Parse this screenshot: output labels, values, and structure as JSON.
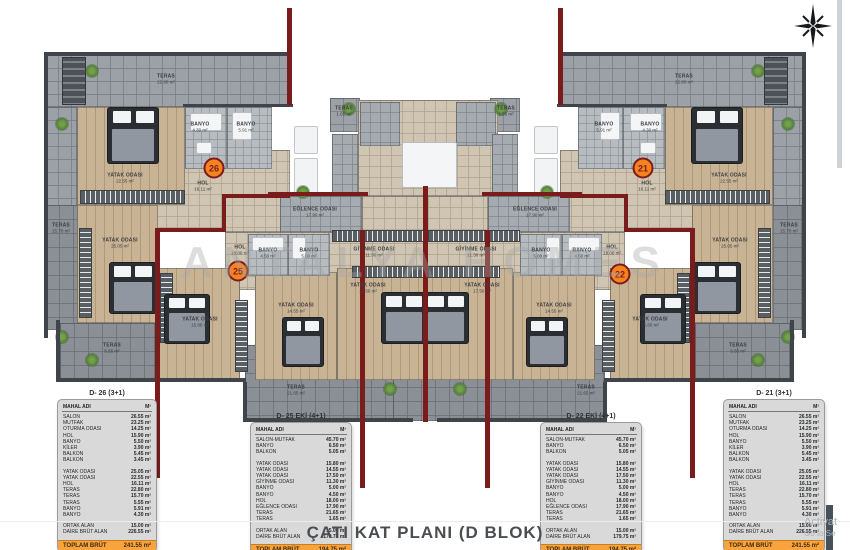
{
  "page": {
    "title": "ÇATI KAT PLANI (D BLOK)",
    "watermark": "ANTALYA HOMES"
  },
  "system": {
    "activate_line1": "Activat",
    "activate_line2": "Go to Se"
  },
  "colors": {
    "accent_orange": "#F5821F",
    "wall_red": "#7B1C1C",
    "total_band": "#F9A33C"
  },
  "badges": [
    {
      "number": "26",
      "x": 214,
      "y": 168
    },
    {
      "number": "25",
      "x": 238,
      "y": 271
    },
    {
      "number": "22",
      "x": 620,
      "y": 274
    },
    {
      "number": "21",
      "x": 643,
      "y": 168
    }
  ],
  "rooms": [
    {
      "name": "TERAS",
      "area": "22.80 m²",
      "x": 166,
      "y": 79
    },
    {
      "name": "TERAS",
      "area": "22.80 m²",
      "x": 684,
      "y": 79
    },
    {
      "name": "TERAS",
      "area": "15.70 m²",
      "x": 61,
      "y": 228
    },
    {
      "name": "TERAS",
      "area": "15.70 m²",
      "x": 789,
      "y": 228
    },
    {
      "name": "TERAS",
      "area": "5.55 m²",
      "x": 112,
      "y": 348
    },
    {
      "name": "TERAS",
      "area": "5.55 m²",
      "x": 738,
      "y": 348
    },
    {
      "name": "TERAS",
      "area": "21.65 m²",
      "x": 296,
      "y": 390
    },
    {
      "name": "TERAS",
      "area": "21.65 m²",
      "x": 586,
      "y": 390
    },
    {
      "name": "TERAS",
      "area": "1.65 m²",
      "x": 344,
      "y": 111
    },
    {
      "name": "TERAS",
      "area": "1.65 m²",
      "x": 506,
      "y": 111
    },
    {
      "name": "YATAK ODASI",
      "area": "22.55 m²",
      "x": 125,
      "y": 178
    },
    {
      "name": "YATAK ODASI",
      "area": "22.55 m²",
      "x": 729,
      "y": 178
    },
    {
      "name": "YATAK ODASI",
      "area": "25.05 m²",
      "x": 120,
      "y": 243
    },
    {
      "name": "YATAK ODASI",
      "area": "25.05 m²",
      "x": 730,
      "y": 243
    },
    {
      "name": "YATAK ODASI",
      "area": "15.80 m²",
      "x": 200,
      "y": 322
    },
    {
      "name": "YATAK ODASI",
      "area": "15.80 m²",
      "x": 650,
      "y": 322
    },
    {
      "name": "YATAK ODASI",
      "area": "14.55 m²",
      "x": 296,
      "y": 308
    },
    {
      "name": "YATAK ODASI",
      "area": "14.55 m²",
      "x": 554,
      "y": 308
    },
    {
      "name": "YATAK ODASI",
      "area": "17.50 m²",
      "x": 368,
      "y": 288
    },
    {
      "name": "YATAK ODASI",
      "area": "17.50 m²",
      "x": 482,
      "y": 288
    },
    {
      "name": "BANYO",
      "area": "4.30 m²",
      "x": 200,
      "y": 127
    },
    {
      "name": "BANYO",
      "area": "5.91 m²",
      "x": 246,
      "y": 127
    },
    {
      "name": "BANYO",
      "area": "5.91 m²",
      "x": 604,
      "y": 127
    },
    {
      "name": "BANYO",
      "area": "4.30 m²",
      "x": 650,
      "y": 127
    },
    {
      "name": "HOL",
      "area": "16.11 m²",
      "x": 203,
      "y": 186
    },
    {
      "name": "HOL",
      "area": "16.11 m²",
      "x": 647,
      "y": 186
    },
    {
      "name": "EĞLENCE ODASI",
      "area": "17.90 m²",
      "x": 315,
      "y": 212
    },
    {
      "name": "EĞLENCE ODASI",
      "area": "17.90 m²",
      "x": 535,
      "y": 212
    },
    {
      "name": "GİYİNME ODASI",
      "area": "11.30 m²",
      "x": 374,
      "y": 252
    },
    {
      "name": "GİYİNME ODASI",
      "area": "11.30 m²",
      "x": 476,
      "y": 252
    },
    {
      "name": "BANYO",
      "area": "4.50 m²",
      "x": 268,
      "y": 253
    },
    {
      "name": "BANYO",
      "area": "5.00 m²",
      "x": 309,
      "y": 253
    },
    {
      "name": "BANYO",
      "area": "5.00 m²",
      "x": 541,
      "y": 253
    },
    {
      "name": "BANYO",
      "area": "4.50 m²",
      "x": 582,
      "y": 253
    },
    {
      "name": "HOL",
      "area": "18.00 m²",
      "x": 240,
      "y": 250
    },
    {
      "name": "HOL",
      "area": "18.00 m²",
      "x": 612,
      "y": 250
    }
  ],
  "tables": [
    {
      "title": "D- 26 (3+1)",
      "columns": [
        "MAHAL ADI",
        "M²"
      ],
      "rows": [
        [
          "SALON",
          "26.55 m²"
        ],
        [
          "MUTFAK",
          "23.25 m²"
        ],
        [
          "OTURMA ODASI",
          "14.25 m²"
        ],
        [
          "HOL",
          "15.90 m²"
        ],
        [
          "BANYO",
          "5.50 m²"
        ],
        [
          "KİLER",
          "3.90 m²"
        ],
        [
          "BALKON",
          "5.45 m²"
        ],
        [
          "BALKON",
          "3.45 m²"
        ],
        null,
        [
          "YATAK ODASI",
          "25.05 m²"
        ],
        [
          "YATAK ODASI",
          "22.55 m²"
        ],
        [
          "HOL",
          "16.11 m²"
        ],
        [
          "TERAS",
          "22.80 m²"
        ],
        [
          "TERAS",
          "15.70 m²"
        ],
        [
          "TERAS",
          "5.55 m²"
        ],
        [
          "BANYO",
          "5.91 m²"
        ],
        [
          "BANYO",
          "4.30 m²"
        ]
      ],
      "summary": [
        [
          "ORTAK ALAN",
          "15.00 m²"
        ],
        [
          "DAİRE BRÜT ALAN",
          "226.55 m²"
        ]
      ],
      "total_label": "TOPLAM BRÜT",
      "total_value": "241.55 m²",
      "x": 57,
      "y": 390,
      "w": 100
    },
    {
      "title": "D- 25 EKİ (4+1)",
      "columns": [
        "MAHAL ADI",
        "M²"
      ],
      "rows": [
        [
          "SALON-MUTFAK",
          "45.70 m²"
        ],
        [
          "BANYO",
          "6.50 m²"
        ],
        [
          "BALKON",
          "5.05 m²"
        ],
        null,
        [
          "YATAK ODASI",
          "15.80 m²"
        ],
        [
          "YATAK ODASI",
          "14.55 m²"
        ],
        [
          "YATAK ODASI",
          "17.50 m²"
        ],
        [
          "GİYİNME ODASI",
          "11.30 m²"
        ],
        [
          "BANYO",
          "5.00 m²"
        ],
        [
          "BANYO",
          "4.50 m²"
        ],
        [
          "HOL",
          "18.00 m²"
        ],
        [
          "EĞLENCE ODASI",
          "17.90 m²"
        ],
        [
          "TERAS",
          "21.65 m²"
        ],
        [
          "TERAS",
          "1.65 m²"
        ]
      ],
      "summary": [
        [
          "ORTAK ALAN",
          "15.00 m²"
        ],
        [
          "DAİRE BRÜT ALAN",
          "179.75 m²"
        ]
      ],
      "total_label": "TOPLAM BRÜT",
      "total_value": "194.75 m²",
      "x": 250,
      "y": 413,
      "w": 102
    },
    {
      "title": "D- 22 EKİ (4+1)",
      "columns": [
        "MAHAL ADI",
        "M²"
      ],
      "rows": [
        [
          "SALON-MUTFAK",
          "45.70 m²"
        ],
        [
          "BANYO",
          "6.50 m²"
        ],
        [
          "BALKON",
          "5.05 m²"
        ],
        null,
        [
          "YATAK ODASI",
          "15.80 m²"
        ],
        [
          "YATAK ODASI",
          "14.55 m²"
        ],
        [
          "YATAK ODASI",
          "17.50 m²"
        ],
        [
          "GİYİNME ODASI",
          "11.30 m²"
        ],
        [
          "BANYO",
          "5.00 m²"
        ],
        [
          "BANYO",
          "4.50 m²"
        ],
        [
          "HOL",
          "18.00 m²"
        ],
        [
          "EĞLENCE ODASI",
          "17.90 m²"
        ],
        [
          "TERAS",
          "21.65 m²"
        ],
        [
          "TERAS",
          "1.65 m²"
        ]
      ],
      "summary": [
        [
          "ORTAK ALAN",
          "15.00 m²"
        ],
        [
          "DAİRE BRÜT ALAN",
          "179.75 m²"
        ]
      ],
      "total_label": "TOPLAM BRÜT",
      "total_value": "194.75 m²",
      "x": 540,
      "y": 413,
      "w": 102
    },
    {
      "title": "D- 21 (3+1)",
      "columns": [
        "MAHAL ADI",
        "M²"
      ],
      "rows": [
        [
          "SALON",
          "26.55 m²"
        ],
        [
          "MUTFAK",
          "23.25 m²"
        ],
        [
          "OTURMA ODASI",
          "14.25 m²"
        ],
        [
          "HOL",
          "15.90 m²"
        ],
        [
          "BANYO",
          "5.50 m²"
        ],
        [
          "KİLER",
          "3.90 m²"
        ],
        [
          "BALKON",
          "5.45 m²"
        ],
        [
          "BALKON",
          "3.45 m²"
        ],
        null,
        [
          "YATAK ODASI",
          "25.05 m²"
        ],
        [
          "YATAK ODASI",
          "22.55 m²"
        ],
        [
          "HOL",
          "16.11 m²"
        ],
        [
          "TERAS",
          "22.80 m²"
        ],
        [
          "TERAS",
          "15.70 m²"
        ],
        [
          "TERAS",
          "5.55 m²"
        ],
        [
          "BANYO",
          "5.91 m²"
        ],
        [
          "BANYO",
          "4.30 m²"
        ]
      ],
      "summary": [
        [
          "ORTAK ALAN",
          "15.00 m²"
        ],
        [
          "DAİRE BRÜT ALAN",
          "226.55 m²"
        ]
      ],
      "total_label": "TOPLAM BRÜT",
      "total_value": "241.55 m²",
      "x": 723,
      "y": 390,
      "w": 102
    }
  ]
}
